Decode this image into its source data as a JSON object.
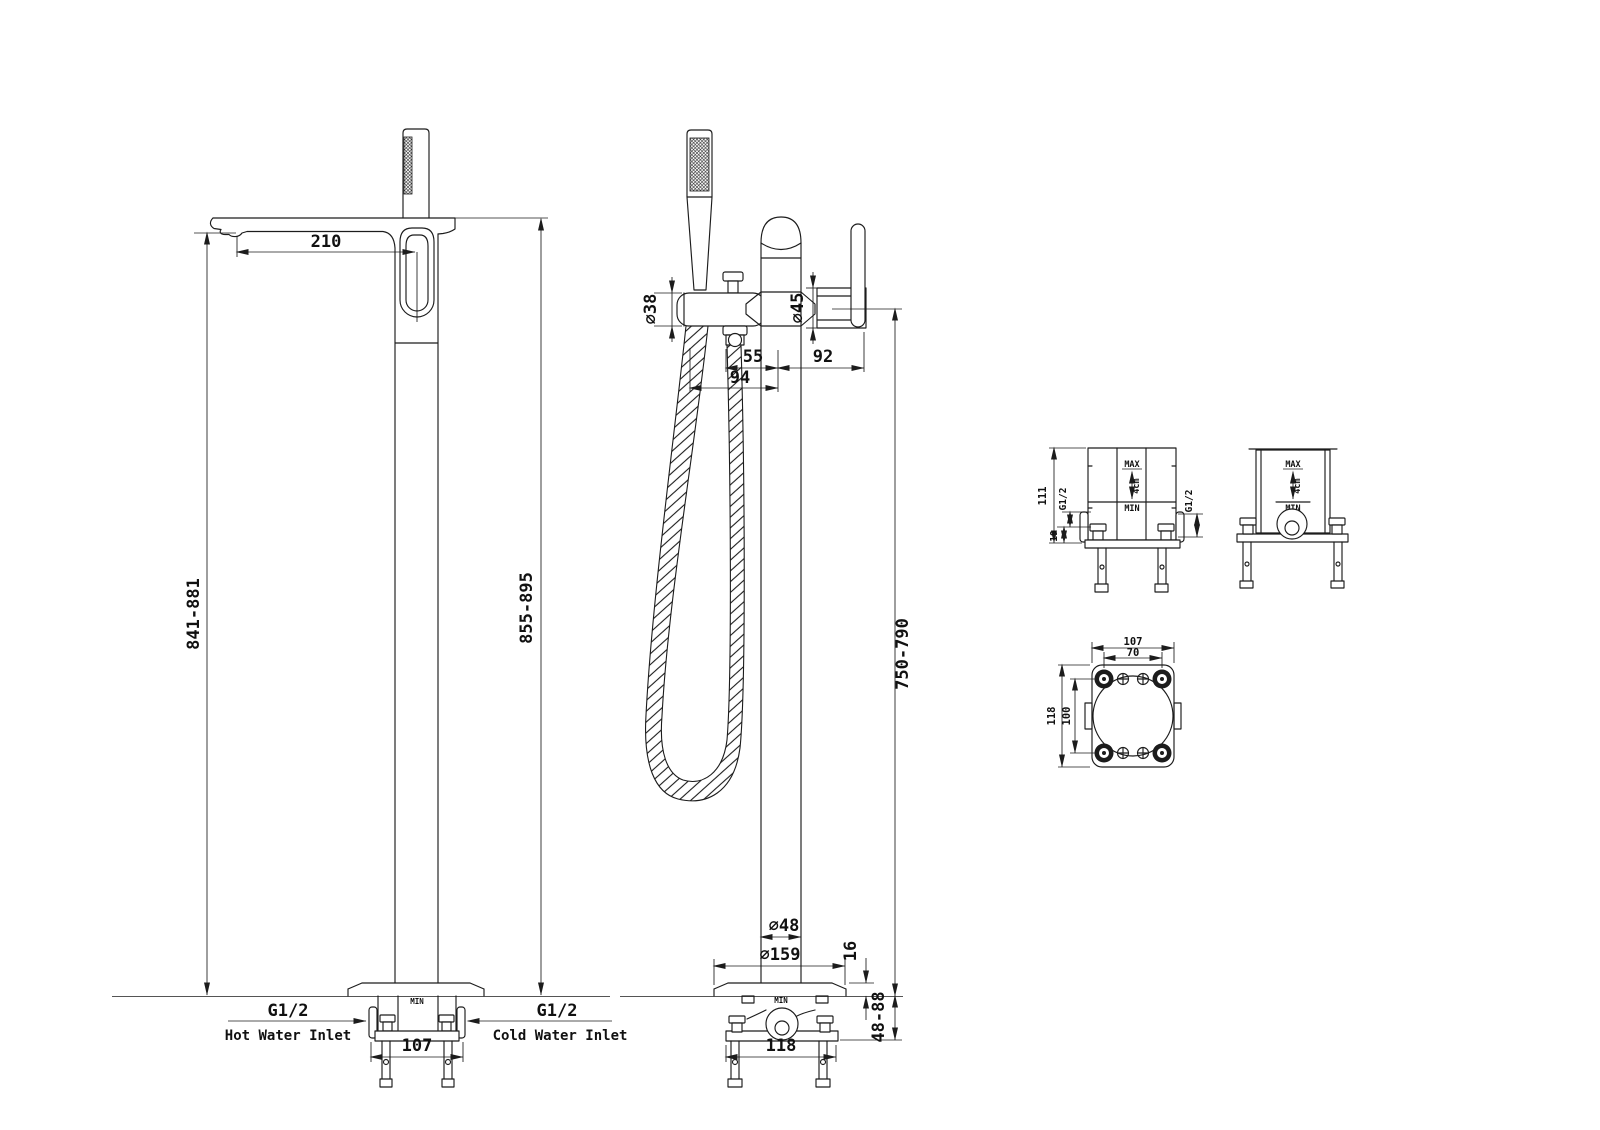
{
  "meta": {
    "background": "#ffffff",
    "line_color": "#1c1c1c"
  },
  "side_view": {
    "dims": {
      "spout_reach": "210",
      "spout_height_range": "841-881",
      "overall_height_range": "855-895",
      "inlet_spacing": "107"
    },
    "labels": {
      "hot_thread": "G1/2",
      "hot_inlet": "Hot Water Inlet",
      "cold_thread": "G1/2",
      "cold_inlet": "Cold Water Inlet",
      "plate_min": "MIN"
    }
  },
  "front_view": {
    "dims": {
      "handset_dia": "∅38",
      "cartridge_dia": "∅45",
      "hose_to_center": "55",
      "center_to_lever": "92",
      "handset_to_center": "94",
      "lever_height_range": "750-790",
      "column_dia": "∅48",
      "base_dia": "∅159",
      "base_thickness": "16",
      "embed_depth_range": "48-88",
      "leg_spacing": "118"
    },
    "labels": {
      "plate_min": "MIN"
    }
  },
  "mount_front_view": {
    "dims": {
      "body_height": "111",
      "inlet_to_base": "19",
      "left_thread": "G1/2",
      "right_thread": "G1/2"
    },
    "labels": {
      "max": "MAX",
      "travel": "4cm",
      "min": "MIN"
    }
  },
  "mount_side_view": {
    "labels": {
      "max": "MAX",
      "travel": "4cm",
      "min": "MIN"
    }
  },
  "mount_top_view": {
    "dims": {
      "plate_width": "107",
      "screw_spacing_x": "70",
      "plate_depth": "118",
      "bolt_spacing_y": "100"
    }
  }
}
